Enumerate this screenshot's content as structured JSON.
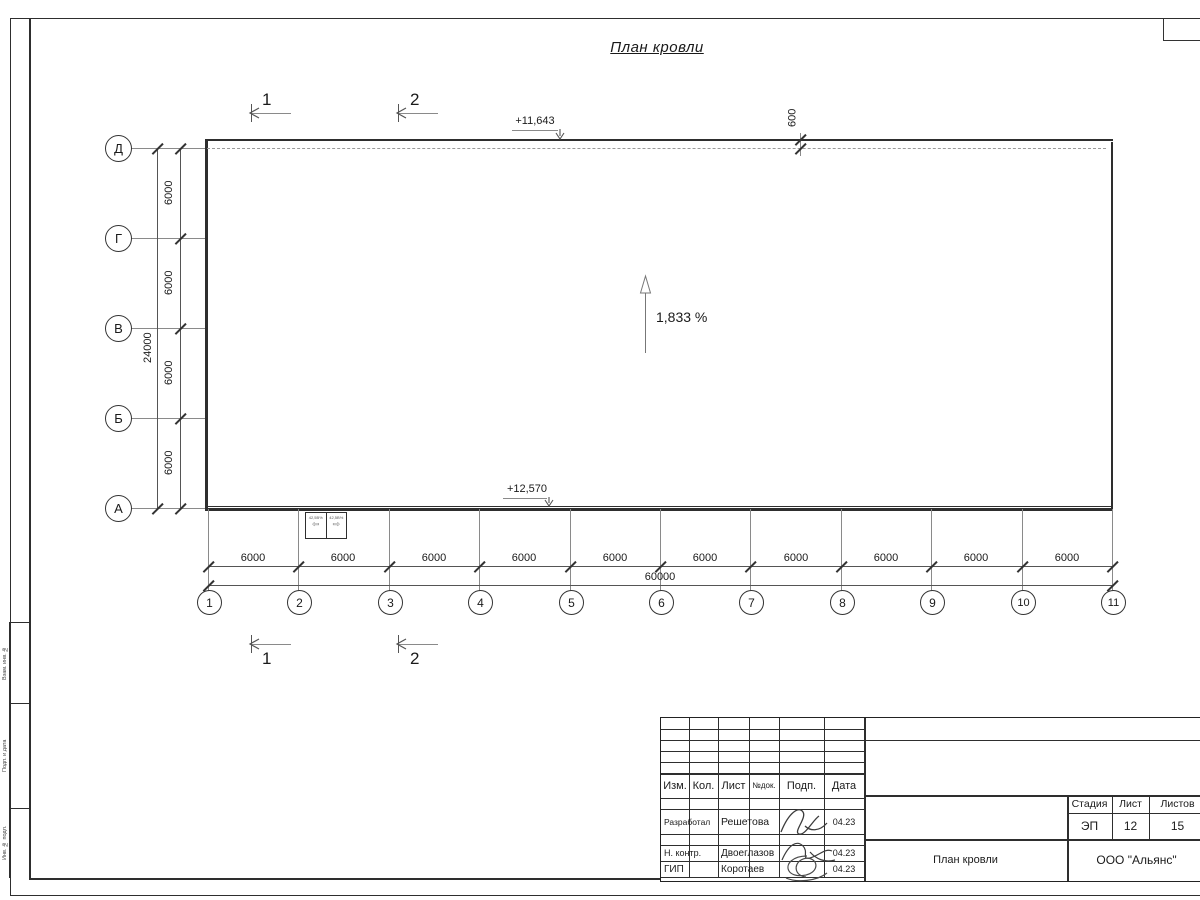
{
  "title": "План кровли",
  "grid": {
    "row_labels": [
      "Д",
      "Г",
      "В",
      "Б",
      "А"
    ],
    "col_labels": [
      "1",
      "2",
      "3",
      "4",
      "5",
      "6",
      "7",
      "8",
      "9",
      "10",
      "11"
    ],
    "row_spacing": "6000",
    "row_total": "24000",
    "col_spacing": "6000",
    "col_total": "60000",
    "parapet_offset": "600"
  },
  "annotations": {
    "elevation_top": "+11,643",
    "elevation_bottom": "+12,570",
    "slope": "1,833 %",
    "section_mark_1": "1",
    "section_mark_2": "2",
    "hatch_box_left": "42,5В%",
    "hatch_box_right": "42,5В%"
  },
  "title_block": {
    "columns": [
      "Изм.",
      "Кол.",
      "Лист",
      "№док.",
      "Подп.",
      "Дата"
    ],
    "rows": [
      {
        "role": "Разработал",
        "name": "Решетова",
        "date": "04.23"
      },
      {
        "role": "Н. контр.",
        "name": "Двоеглазов",
        "date": "04.23"
      },
      {
        "role": "ГИП",
        "name": "Коротаев",
        "date": "04.23"
      }
    ],
    "stage_label": "Стадия",
    "sheet_label": "Лист",
    "sheets_label": "Листов",
    "stage": "ЭП",
    "sheet": "12",
    "sheets": "15",
    "doc_title": "План кровли",
    "company": "ООО \"Альянс\""
  },
  "frame": {
    "side_labels": [
      "Взам. инв. №",
      "Подп. и дата",
      "Инв. № подл."
    ]
  }
}
